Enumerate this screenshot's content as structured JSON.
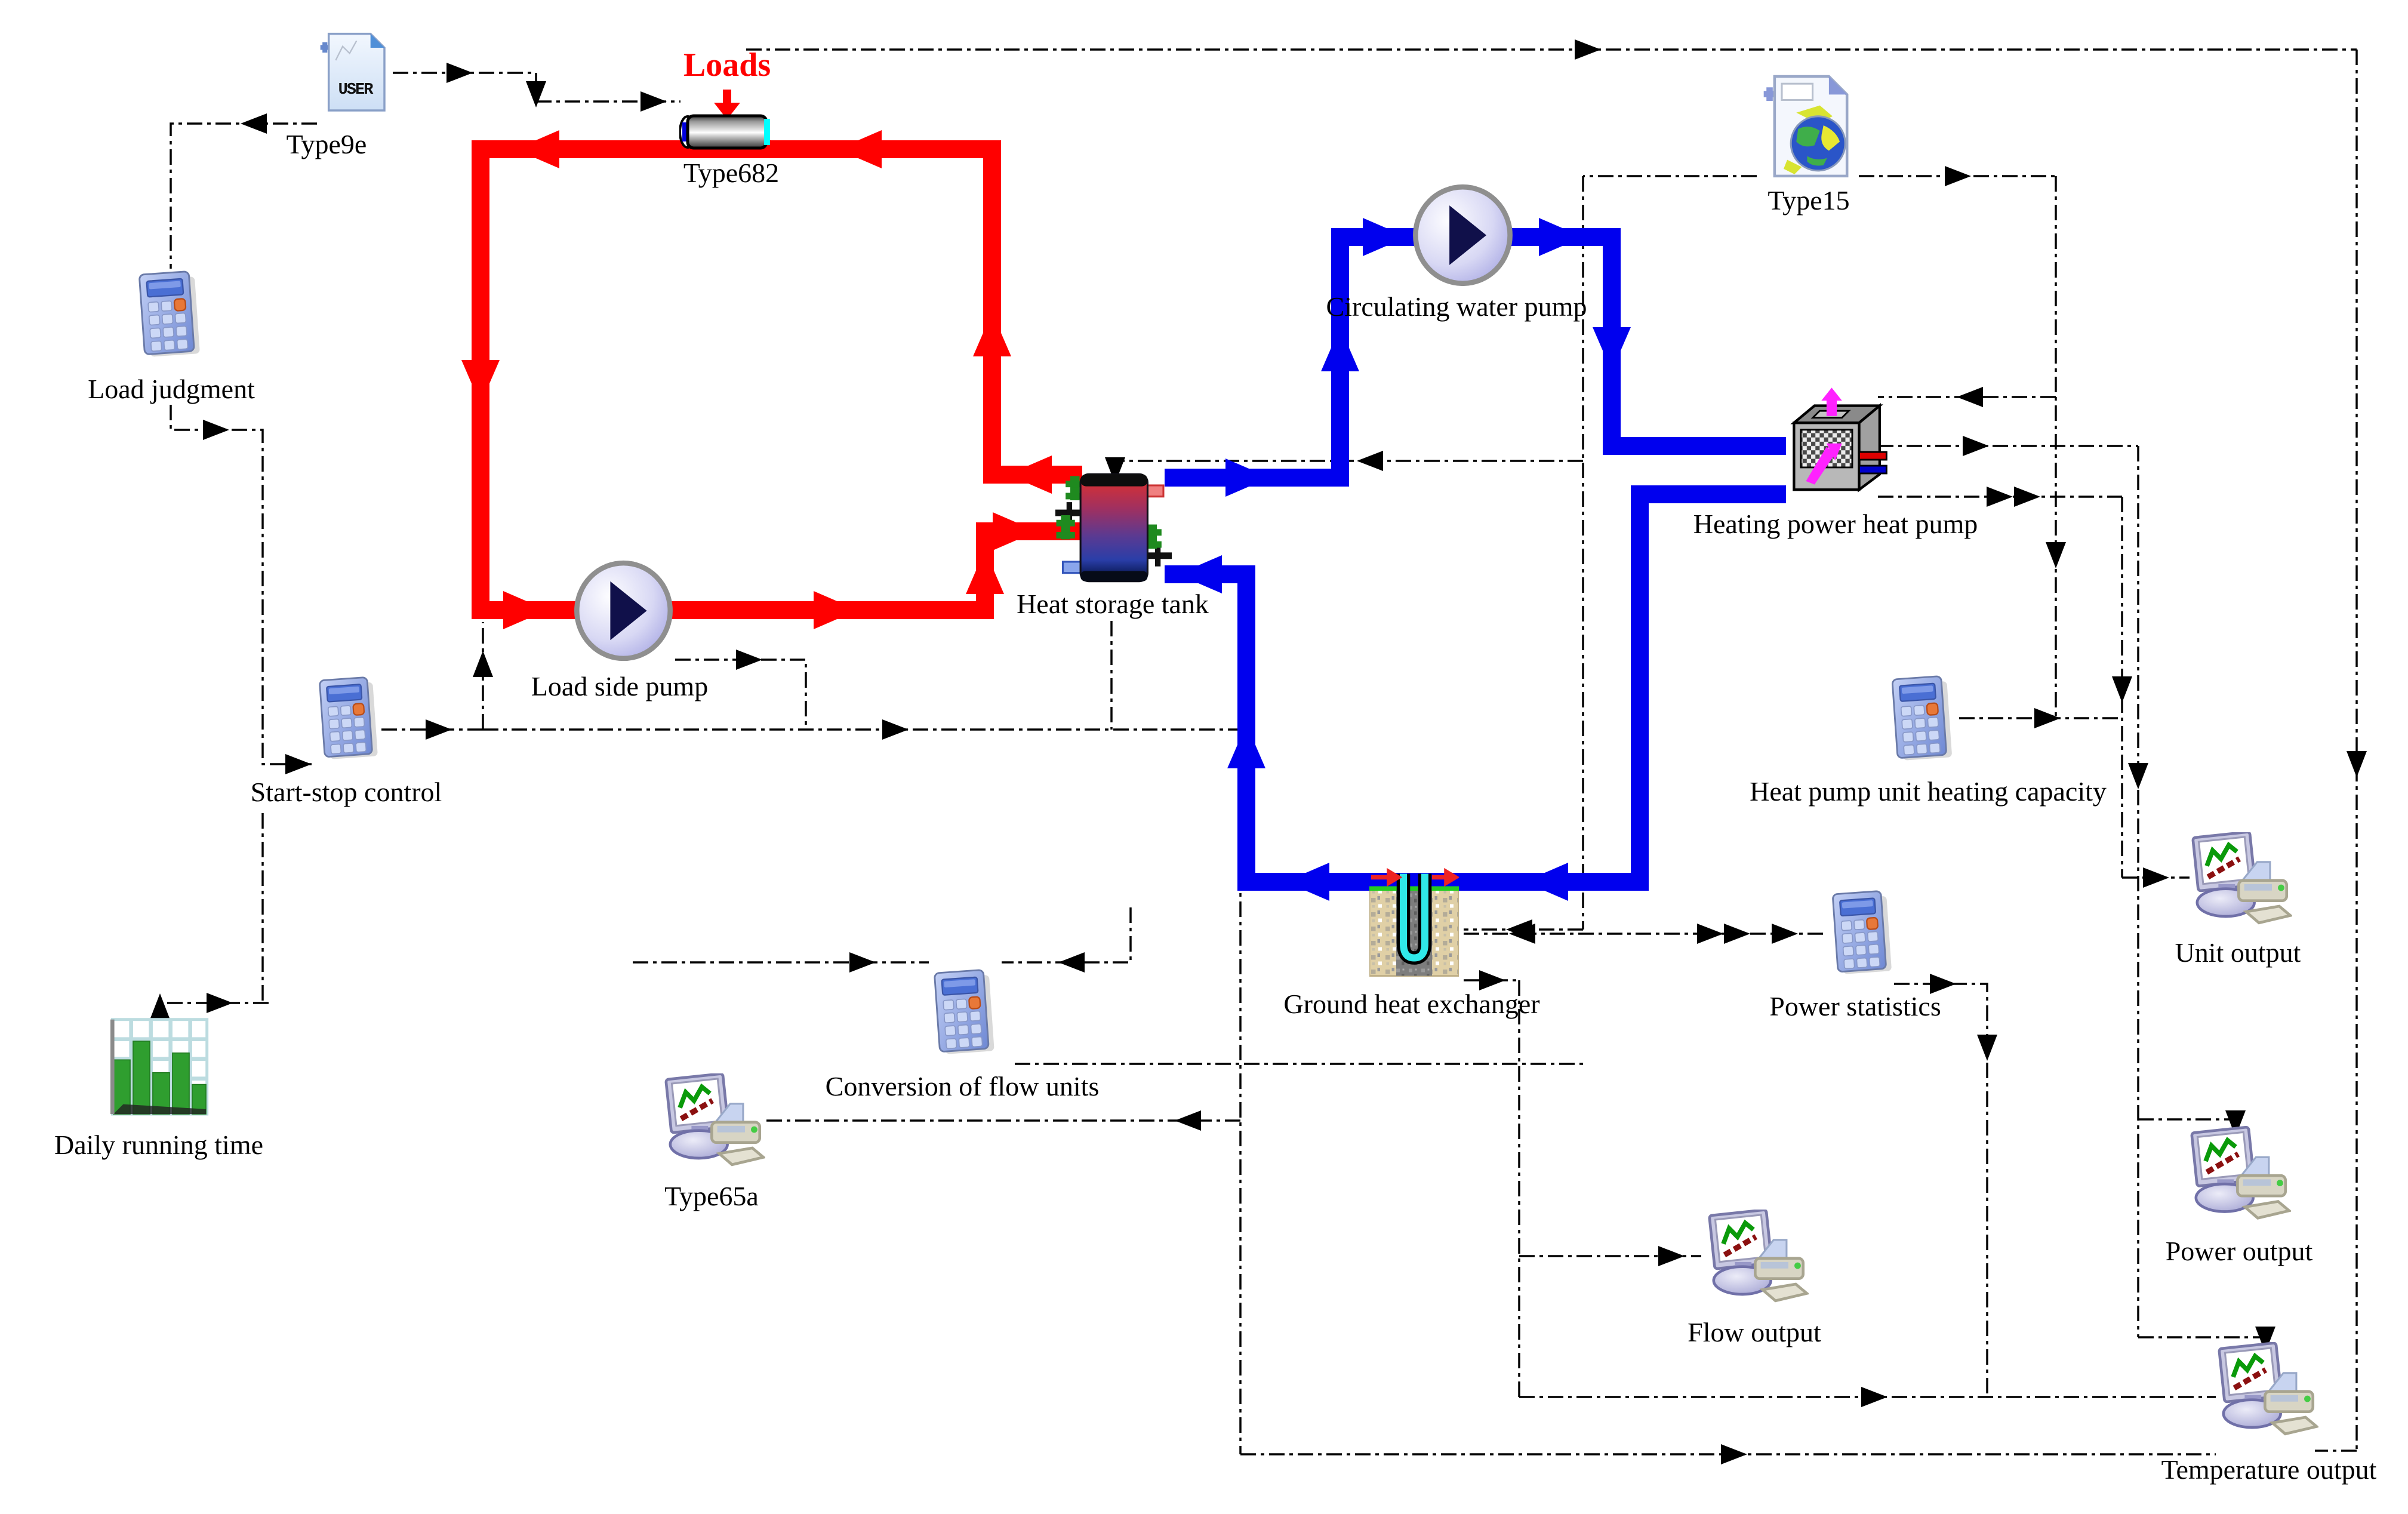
{
  "diagram": {
    "title": "Ground-source heat pump with heat storage tank - simulation layout",
    "background": "#ffffff"
  },
  "colors": {
    "hot_loop": "#ff0000",
    "cold_loop": "#0000ee",
    "link": "#000000",
    "loads_text": "#ff0000"
  },
  "components": {
    "type9e": {
      "label": "Type9e",
      "icon_text": "USER"
    },
    "loads_annotation": {
      "label": "Loads"
    },
    "type682": {
      "label": "Type682"
    },
    "load_judgment": {
      "label": "Load judgment"
    },
    "load_side_pump": {
      "label": "Load side pump"
    },
    "start_stop_control": {
      "label": "Start-stop control"
    },
    "daily_running_time": {
      "label": "Daily running time"
    },
    "heat_storage_tank": {
      "label": "Heat storage tank"
    },
    "circulating_water_pump": {
      "label": "Circulating water pump"
    },
    "type15": {
      "label": "Type15"
    },
    "heating_power_heat_pump": {
      "label": "Heating power heat pump"
    },
    "heat_pump_unit_heating_capacity": {
      "label": "Heat pump unit heating capacity"
    },
    "ground_heat_exchanger": {
      "label": "Ground heat exchanger"
    },
    "power_statistics": {
      "label": "Power statistics"
    },
    "conversion_of_flow_units": {
      "label": "Conversion of flow units"
    },
    "type65a": {
      "label": "Type65a"
    },
    "flow_output": {
      "label": "Flow output"
    },
    "unit_output": {
      "label": "Unit output"
    },
    "power_output": {
      "label": "Power output"
    },
    "temperature_output": {
      "label": "Temperature output"
    }
  }
}
